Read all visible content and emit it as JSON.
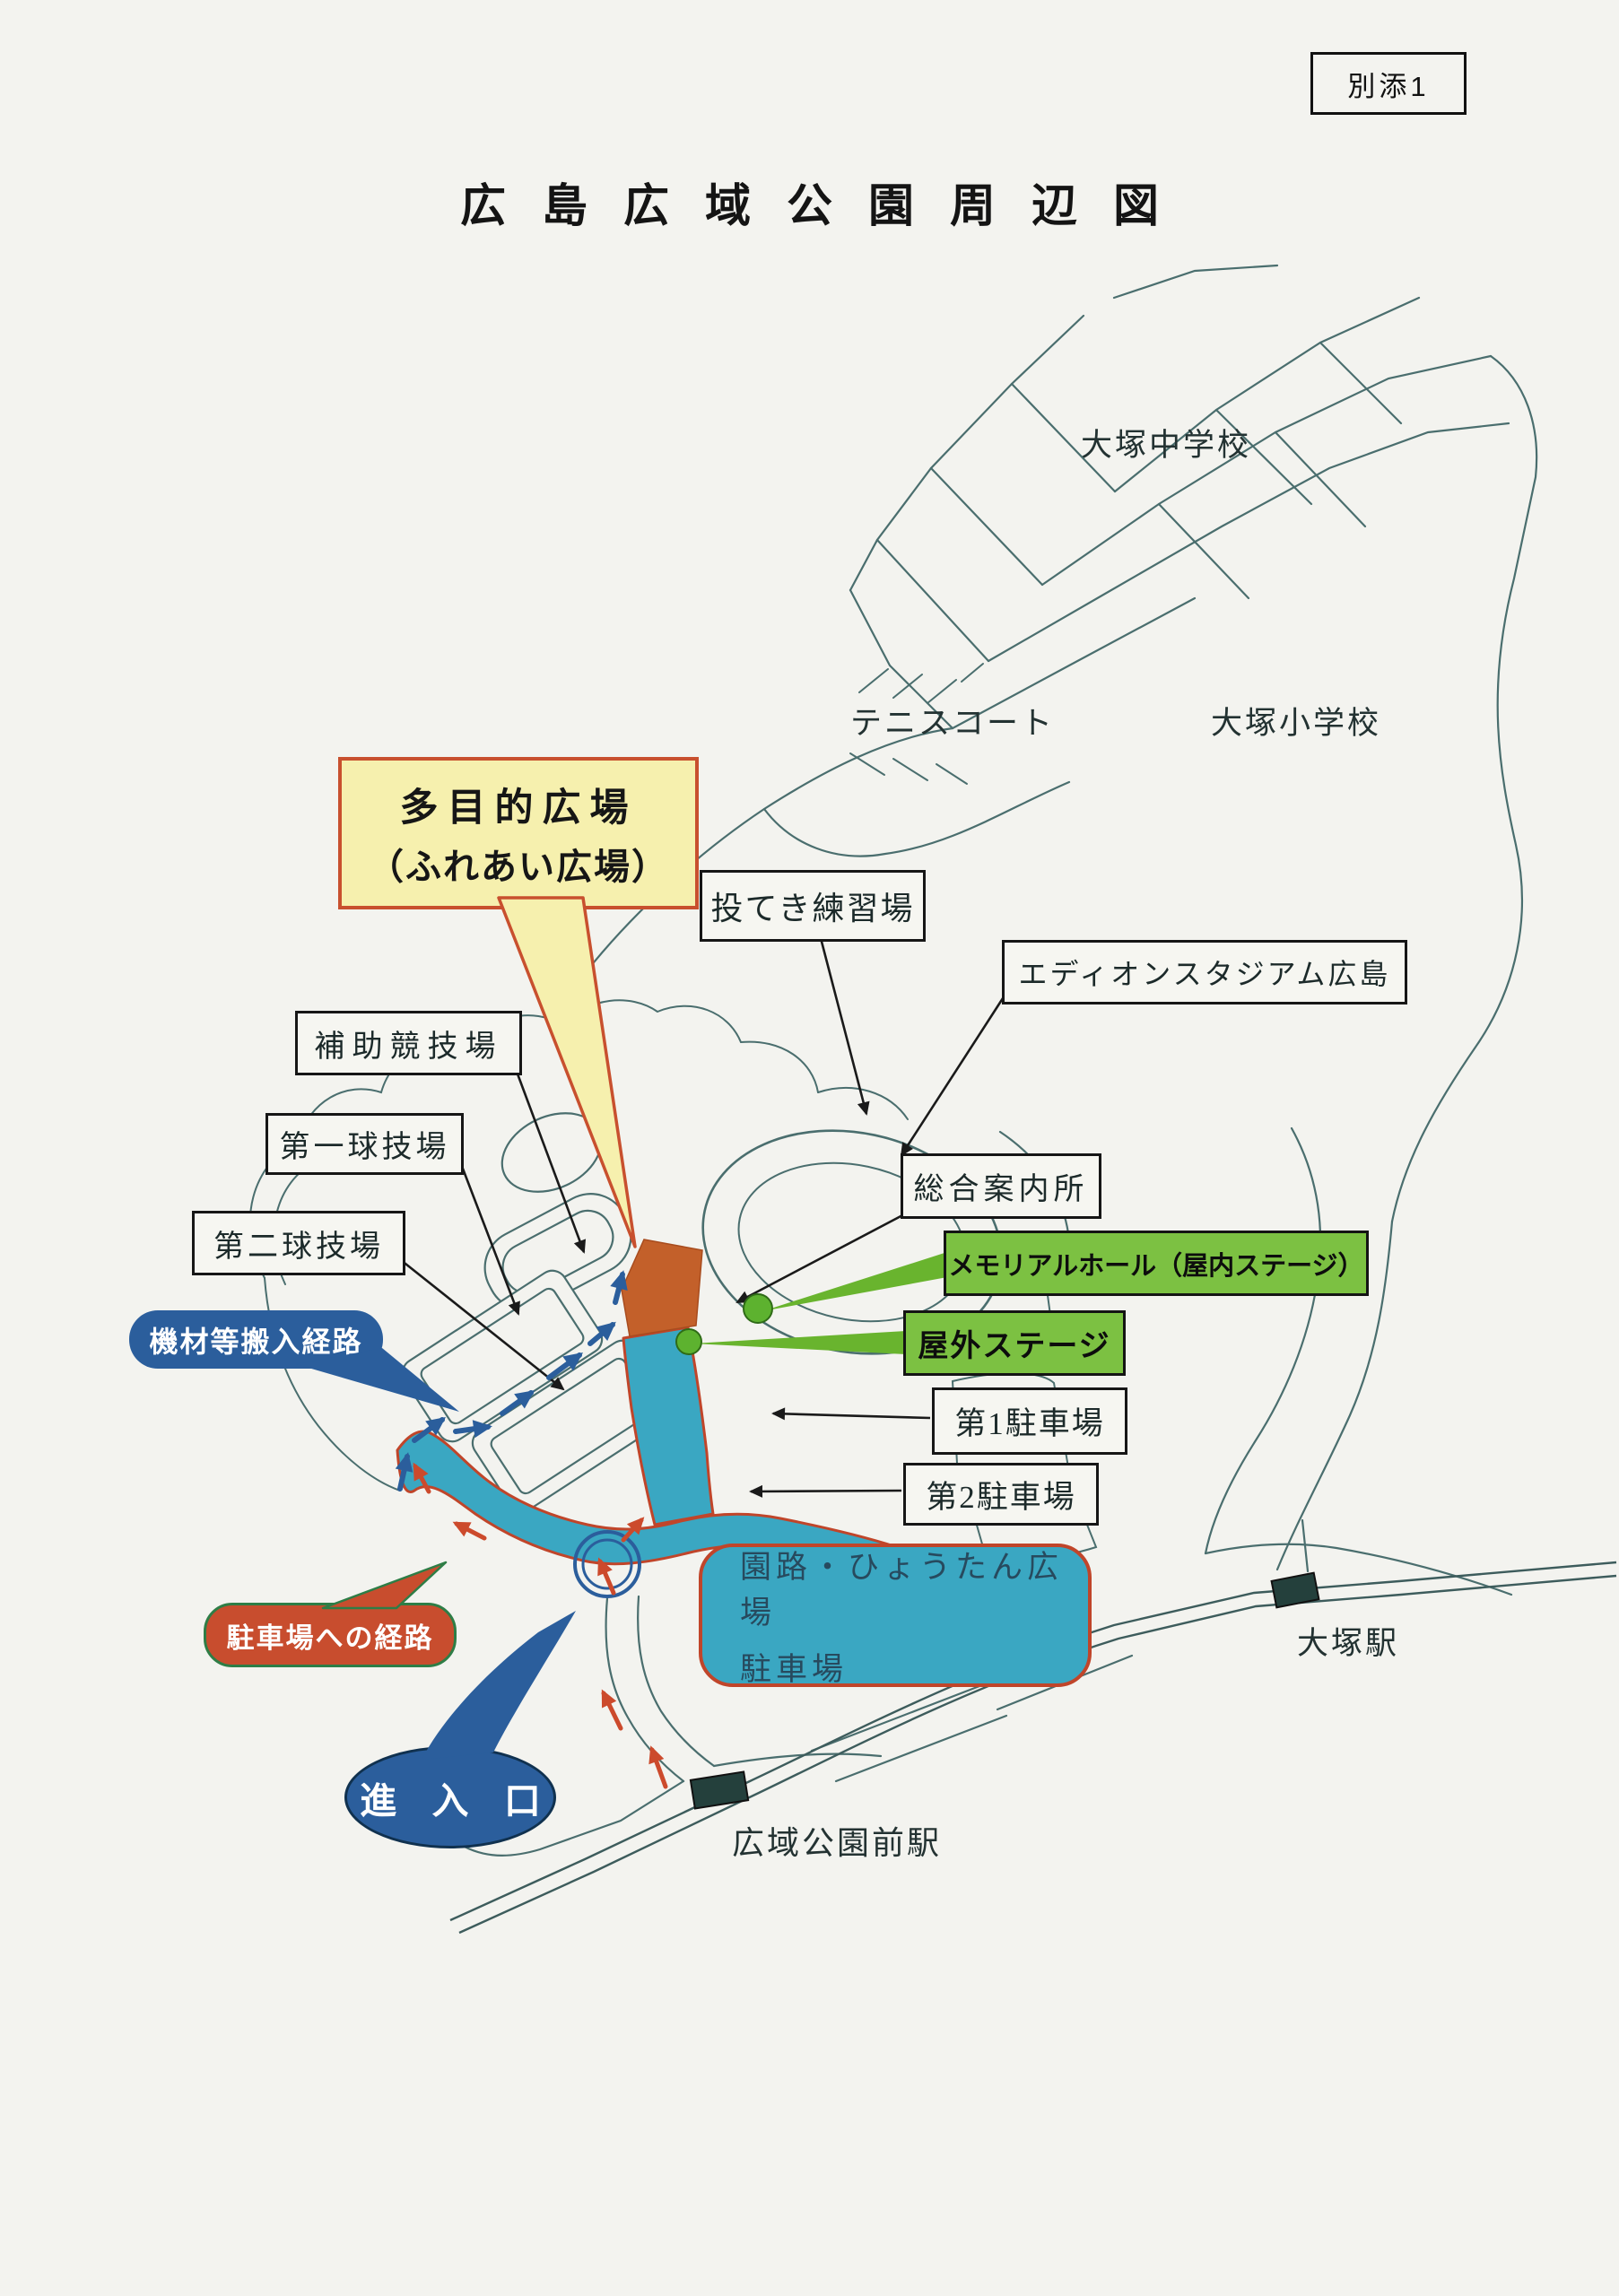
{
  "page": {
    "attachment": "別添1",
    "title": "広島広域公園周辺図"
  },
  "labels": {
    "otsuka_junior_high": "大塚中学校",
    "tennis_court": "テニスコート",
    "otsuka_elementary": "大塚小学校",
    "otsuka_station": "大塚駅",
    "koikikoenmae_station": "広域公園前駅"
  },
  "boxes": {
    "throwing_practice": "投てき練習場",
    "edion_stadium": "エディオンスタジアム広島",
    "auxiliary_stadium": "補助競技場",
    "ball_field_1": "第一球技場",
    "ball_field_2": "第二球技場",
    "information_center": "総合案内所",
    "parking_1": "第1駐車場",
    "parking_2": "第2駐車場"
  },
  "stages": {
    "memorial_hall": "メモリアルホール（屋内ステージ）",
    "outdoor_stage": "屋外ステージ"
  },
  "callouts": {
    "multipurpose_plaza": {
      "line1": "多目的広場",
      "line2": "（ふれあい広場）"
    },
    "equipment_route": "機材等搬入経路",
    "parking_route": "駐車場への経路",
    "entrance": "進 入 口",
    "park_path_parking": {
      "line1": "園路・ひょうたん広場",
      "line2": "駐車場"
    }
  },
  "map": {
    "icons": {
      "station_marker": "dark-rectangle",
      "stage_marker": "green-dot",
      "entry_point_marker": "blue-double-circle",
      "equipment_route_marker": "blue-arrows",
      "parking_route_marker": "red-arrows"
    },
    "colors": {
      "paper": "#F3F3EF",
      "map_line": "#4A6E6E",
      "route_highlight_fill": "#3AA7C2",
      "route_highlight_border": "#C0452A",
      "plaza_area_fill": "#C3602A",
      "stage_label_fill": "#7CC142",
      "callout_yellow_fill": "#F6F0AE",
      "callout_yellow_border": "#C8502E",
      "blue_accent": "#2B5E9C",
      "red_accent": "#C84D2E",
      "arrow_red": "#CC4A2C"
    }
  }
}
